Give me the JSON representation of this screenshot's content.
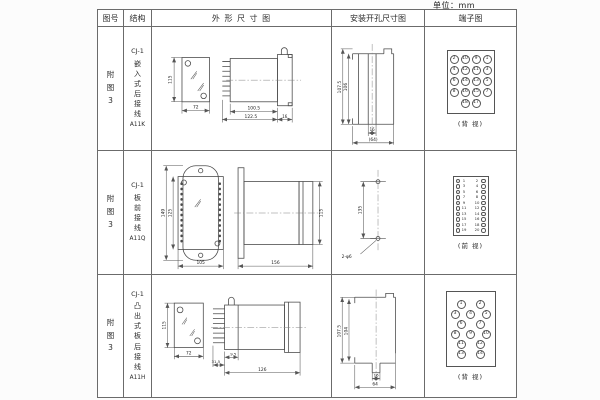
{
  "unit_label": "单位：mm",
  "header": {
    "figure": "图号",
    "structure": "结构",
    "outline": "外 形 尺 寸 图",
    "mounting": "安装开孔尺寸图",
    "terminal": "端子图"
  },
  "rows": [
    {
      "figure": "附\n图\n3",
      "model": "CJ-1",
      "structure_type": "嵌\n入\n式\n后\n接\n线",
      "code": "A11K",
      "outline": {
        "h": "115",
        "w": "72",
        "d1": "100.5",
        "d2": "122.5",
        "flange": "16"
      },
      "mounting": {
        "v1": "107.5",
        "v2": "106",
        "w1": "16",
        "w2": "(64)"
      },
      "terminal": {
        "view": "(背 视)",
        "rows": [
          [
            "2",
            "10",
            "9",
            "1"
          ],
          [
            "4",
            "12",
            "11",
            "3"
          ],
          [
            "6",
            "14",
            "13",
            "5"
          ],
          [
            "8",
            "16",
            "15",
            "7"
          ],
          [
            "18",
            "17"
          ]
        ]
      }
    },
    {
      "figure": "附\n图\n3",
      "model": "CJ-1",
      "structure_type": "板\n前\n接\n线",
      "code": "A11Q",
      "outline": {
        "h1": "149",
        "h2": "125",
        "w": "105",
        "d": "156",
        "side_h": "115"
      },
      "mounting": {
        "v": "135",
        "holes": "2-φ6"
      },
      "terminal": {
        "view": "(前 视)",
        "left": [
          "1",
          "3",
          "5",
          "7",
          "9",
          "11",
          "13",
          "15",
          "17",
          "19"
        ],
        "right": [
          "2",
          "4",
          "6",
          "8",
          "10",
          "12",
          "14",
          "16",
          "18",
          "20"
        ]
      }
    },
    {
      "figure": "附\n图\n3",
      "model": "CJ-1",
      "structure_type": "凸\n出\n式\n板\n后\n接\n线",
      "code": "A11H",
      "outline": {
        "h": "115",
        "w": "72",
        "d1": "31.5",
        "d2": "9.5",
        "d3": "126"
      },
      "mounting": {
        "v1": "107.5",
        "v2": "104",
        "w1": "16",
        "w2": "64"
      },
      "terminal": {
        "view": "(背 视)",
        "rows": [
          [
            "1",
            "2"
          ],
          [
            "3",
            "4",
            "5"
          ],
          [
            "6",
            "7"
          ],
          [
            "8",
            "9",
            "10"
          ],
          [
            "11",
            "12"
          ],
          [
            "13",
            "14"
          ]
        ]
      }
    }
  ]
}
